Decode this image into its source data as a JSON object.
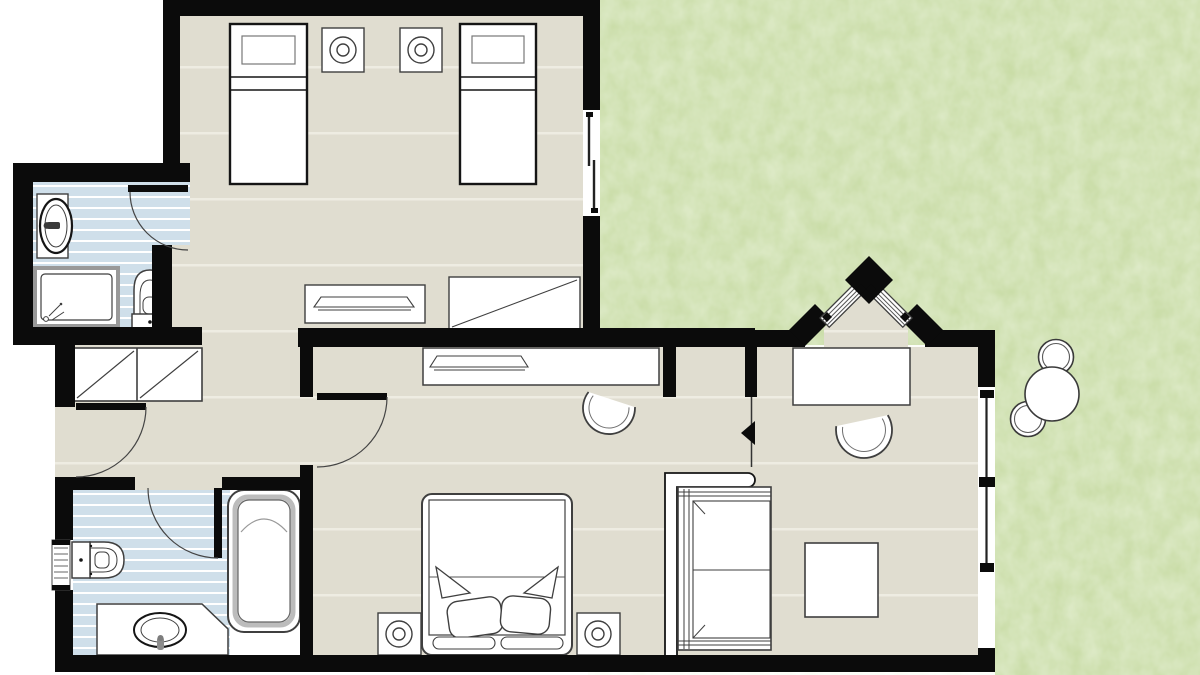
{
  "colors": {
    "background": "#ffffff",
    "wall": "#0b0b0b",
    "floor": "#e0ddd0",
    "floor-line": "#eeece2",
    "tile": "#cfdfea",
    "tile-line": "#ffffff",
    "garden": "#c7dba3",
    "fixture": "#ffffff",
    "outline": "#3f3f3f",
    "outline-dark": "#151515",
    "outline-soft": "#999999",
    "metal": "#8c8c8c"
  },
  "plan": {
    "type": "floor-plan",
    "rooms": [
      {
        "name": "twin-bedroom",
        "fixtures": [
          "single-bed",
          "single-bed",
          "nightstand-lamp",
          "nightstand-lamp",
          "dresser-tray",
          "wardrobe",
          "sliding-window"
        ]
      },
      {
        "name": "bathroom-upper",
        "fixtures": [
          "washbasin",
          "shower-tray",
          "toilet",
          "swing-door"
        ]
      },
      {
        "name": "hallway",
        "fixtures": [
          "double-closet",
          "entry-door"
        ]
      },
      {
        "name": "bathroom-lower",
        "fixtures": [
          "toilet",
          "bathtub",
          "vanity-washbasin",
          "louver-window",
          "swing-door"
        ]
      },
      {
        "name": "master-bedroom",
        "fixtures": [
          "console-tray",
          "desk-chair",
          "double-bed",
          "nightstand-lamp",
          "nightstand-lamp",
          "swing-door"
        ]
      },
      {
        "name": "living-area",
        "fixtures": [
          "desk",
          "desk-chair",
          "sofa",
          "screen-partition",
          "ottoman-table",
          "double-window",
          "direction-marker"
        ]
      },
      {
        "name": "entrance-bay",
        "fixtures": [
          "angled-door-panel",
          "angled-door-panel",
          "corner-pier"
        ]
      },
      {
        "name": "garden",
        "fixtures": [
          "shrub-large",
          "shrub-small",
          "shrub-small"
        ]
      }
    ]
  }
}
